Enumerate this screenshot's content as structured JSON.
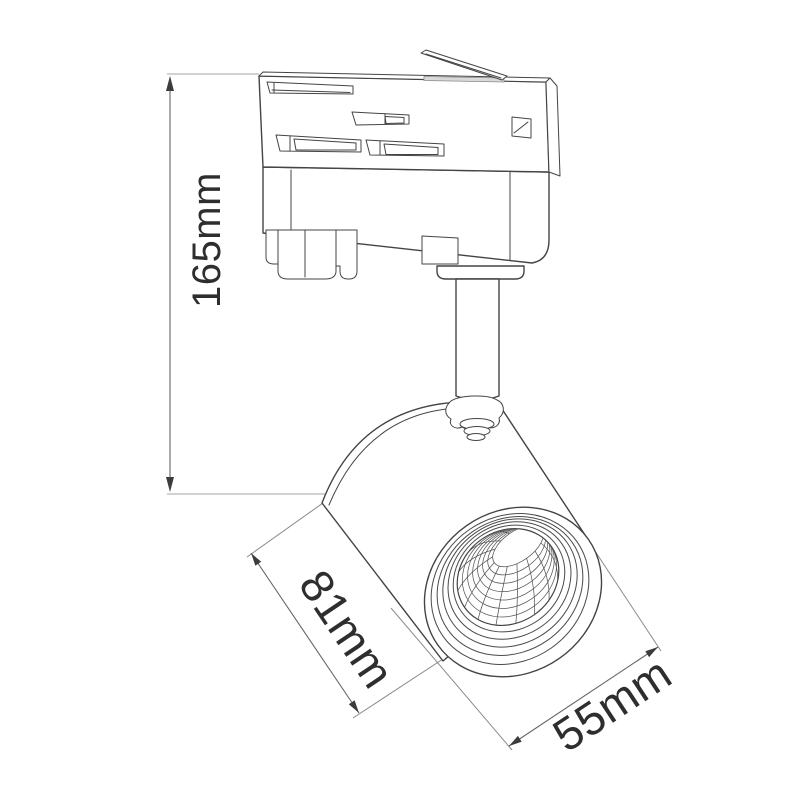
{
  "drawing": {
    "kind": "technical dimension line drawing of a track-mounted spotlight"
  },
  "dimensions": {
    "height": {
      "label": "165mm"
    },
    "body_length": {
      "label": "81mm"
    },
    "face_diameter": {
      "label": "55mm"
    }
  },
  "colors": {
    "outline": "#444444",
    "mesh_line": "#565656",
    "dimension_line": "#666666",
    "extension_line": "#999999",
    "label_text": "#2e2e2e",
    "background": "#ffffff"
  }
}
